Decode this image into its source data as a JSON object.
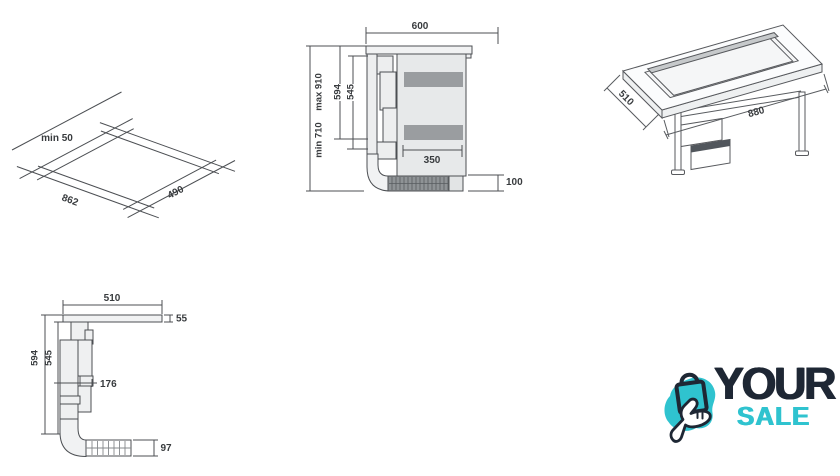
{
  "page": {
    "background": "#ffffff"
  },
  "drawings": {
    "cutout_plan": {
      "clearance": "min 50",
      "cutout_width": "862",
      "cutout_depth": "490"
    },
    "cabinet_side": {
      "top_width": "600",
      "height_max": "max 910",
      "height_min": "min 710",
      "duct_height": "594",
      "inner_height": "545",
      "base_depth": "350",
      "plinth_height": "100"
    },
    "installed_iso": {
      "worktop_depth": "510",
      "worktop_width": "880"
    },
    "hood_side": {
      "top_width": "510",
      "top_thickness": "55",
      "duct_height": "594",
      "inner_height": "545",
      "duct_depth": "176",
      "plinth_duct_height": "97"
    }
  },
  "logo": {
    "brand_top": "YOUR",
    "brand_bottom": "SALE",
    "color_navy": "#1e2734",
    "color_teal": "#2fc3cf",
    "icons": [
      "shopping-bag-icon",
      "tap-hand-icon"
    ]
  }
}
